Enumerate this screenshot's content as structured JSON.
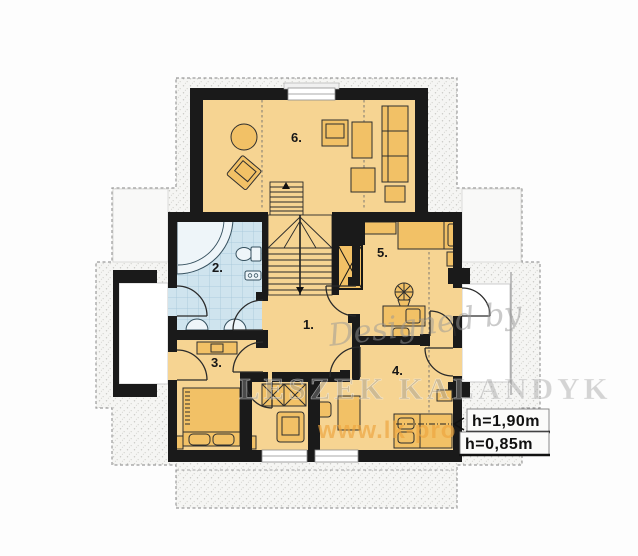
{
  "plan": {
    "rooms": [
      {
        "label": "1."
      },
      {
        "label": "2."
      },
      {
        "label": "3."
      },
      {
        "label": "4."
      },
      {
        "label": "5."
      },
      {
        "label": "6."
      }
    ],
    "height_labels": [
      {
        "text": "h=1,90m"
      },
      {
        "text": "h=0,85m"
      }
    ]
  },
  "watermark": {
    "designed_by": "Designed by",
    "author": "LESZEK KALANDYK",
    "website": "www.lk-pro"
  },
  "theme": {
    "wall": "#1a1a1a",
    "floor": "#f6d492",
    "furniture": "#f2c166",
    "bath_floor": "#cfe4ee",
    "tile_line": "#a3c6d8",
    "outline": "#9b9b9b",
    "watermark_orange": "#eda43c"
  }
}
